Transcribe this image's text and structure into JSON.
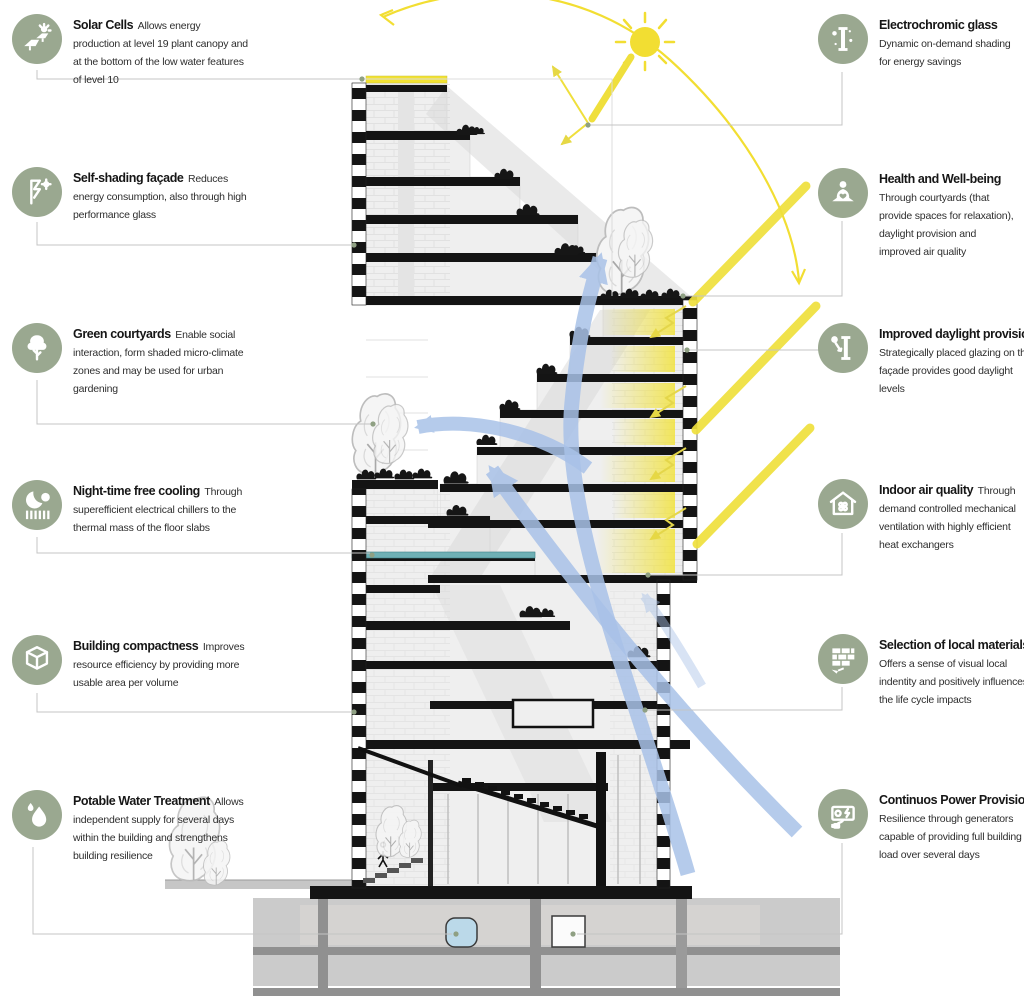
{
  "diagram_title": "Building sustainability section diagram",
  "features_left": [
    {
      "icon": "solar-cells-icon",
      "title": "Solar Cells",
      "description": "Allows energy production at level 19 plant canopy and at the bottom of the low water features of level 10"
    },
    {
      "icon": "self-shading-facade-icon",
      "title": "Self-shading façade",
      "description": "Reduces energy consumption, also through high performance glass"
    },
    {
      "icon": "green-courtyards-icon",
      "title": "Green courtyards",
      "description": "Enable social interaction, form shaded micro-climate zones and may be used for urban gardening"
    },
    {
      "icon": "night-cooling-icon",
      "title": "Night-time free cooling",
      "description": "Through superefficient electrical chillers to the thermal mass of the floor slabs"
    },
    {
      "icon": "building-compactness-icon",
      "title": "Building compactness",
      "description": "Improves resource efficiency by providing more usable area per volume"
    },
    {
      "icon": "potable-water-icon",
      "title": "Potable Water Treatment",
      "description": "Allows independent supply for several days within the building and strengthens building resilience"
    }
  ],
  "features_right": [
    {
      "icon": "electrochromic-glass-icon",
      "title": "Electrochromic glass",
      "description": "Dynamic on-demand shading for energy savings"
    },
    {
      "icon": "health-wellbeing-icon",
      "title": "Health and Well-being",
      "description": "Through courtyards (that provide spaces for relaxation), daylight provision and improved air quality"
    },
    {
      "icon": "daylight-provision-icon",
      "title": "Improved daylight provision",
      "description": "Strategically placed glazing on the façade provides good daylight levels"
    },
    {
      "icon": "indoor-air-quality-icon",
      "title": "Indoor air quality",
      "description": "Through demand controlled mechanical ventilation with highly efficient heat exchangers"
    },
    {
      "icon": "local-materials-icon",
      "title": "Selection of local materials",
      "description": "Offers a sense of visual local indentity and positively influences the life cycle impacts"
    },
    {
      "icon": "continuous-power-icon",
      "title": "Continuos Power Provision",
      "description": "Resilience through generators capable of providing full building load over several days"
    }
  ],
  "scene_elements": [
    "sun",
    "sun-path-arc",
    "solar-rays",
    "daylight-reflection-arrows",
    "airflow-arrows",
    "building-cross-section",
    "courtyard-trees",
    "terrace-plants",
    "roof-solar-strip",
    "chilled-slab",
    "potable-water-tank",
    "generator-tank",
    "basement"
  ],
  "colors": {
    "icon_circle": "#9AA890",
    "sun_yellow": "#F2DE32",
    "ray_yellow": "#EFDF3C",
    "daylight_glow": "#F2E232",
    "airflow_blue": "#A9C2E8",
    "leader_gray": "#C4C4C4",
    "leader_dot": "#8FA083",
    "teal_slab": "#6FB0B5",
    "water_tank_blue": "#BBD9E9",
    "basement_gray": "#CBCBCB"
  }
}
